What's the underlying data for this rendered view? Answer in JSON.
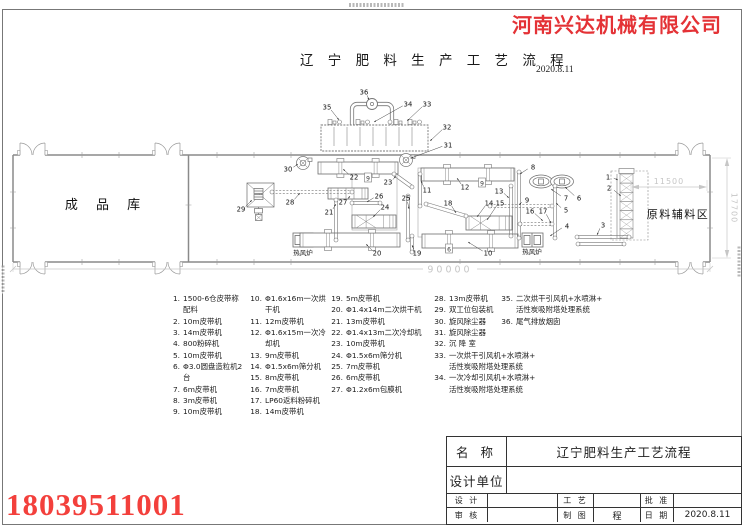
{
  "header": {
    "company": "河南兴达机械有限公司",
    "title": "辽 宁 肥 料 生 产 工 艺 流 程",
    "date": "2020.8.11"
  },
  "footer": {
    "phone": "18039511001"
  },
  "drawing": {
    "area_left": "成 品 库",
    "area_right": "原料辅料区",
    "furnace_label": "热风炉",
    "dimensions": {
      "total_length": "90000",
      "raw_area_width": "11500",
      "building_depth": "17700"
    },
    "tags": [
      {
        "t": "9",
        "x": 368,
        "y": 178
      },
      {
        "t": "9",
        "x": 482,
        "y": 183
      },
      {
        "t": "6",
        "x": 449,
        "y": 249
      }
    ],
    "labels": [
      {
        "n": "1",
        "x": 608,
        "y": 177,
        "tx": 618,
        "ty": 180
      },
      {
        "n": "2",
        "x": 609,
        "y": 188,
        "tx": 621,
        "ty": 196
      },
      {
        "n": "3",
        "x": 603,
        "y": 225,
        "tx": 597,
        "ty": 235
      },
      {
        "n": "4",
        "x": 567,
        "y": 226,
        "tx": 550,
        "ty": 236
      },
      {
        "n": "5",
        "x": 566,
        "y": 210,
        "tx": 556,
        "ty": 203
      },
      {
        "n": "6",
        "x": 579,
        "y": 198,
        "tx": 565,
        "ty": 187
      },
      {
        "n": "7",
        "x": 566,
        "y": 198,
        "tx": 551,
        "ty": 189
      },
      {
        "n": "8",
        "x": 533,
        "y": 167,
        "tx": 520,
        "ty": 174
      },
      {
        "n": "9",
        "x": 527,
        "y": 200,
        "tx": 519,
        "ty": 205
      },
      {
        "n": "10",
        "x": 488,
        "y": 253,
        "tx": 468,
        "ty": 242
      },
      {
        "n": "11",
        "x": 427,
        "y": 190,
        "tx": 421,
        "ty": 181
      },
      {
        "n": "12",
        "x": 465,
        "y": 187,
        "tx": 457,
        "ty": 178
      },
      {
        "n": "13",
        "x": 499,
        "y": 191,
        "tx": 509,
        "ty": 198
      },
      {
        "n": "14",
        "x": 489,
        "y": 203,
        "tx": 477,
        "ty": 217
      },
      {
        "n": "15",
        "x": 500,
        "y": 203,
        "tx": 487,
        "ty": 220
      },
      {
        "n": "16",
        "x": 530,
        "y": 211,
        "tx": 543,
        "ty": 221
      },
      {
        "n": "17",
        "x": 543,
        "y": 211,
        "tx": 551,
        "ty": 223
      },
      {
        "n": "18",
        "x": 448,
        "y": 203,
        "tx": 456,
        "ty": 213
      },
      {
        "n": "19",
        "x": 417,
        "y": 253,
        "tx": 412,
        "ty": 245
      },
      {
        "n": "20",
        "x": 377,
        "y": 253,
        "tx": 366,
        "ty": 244
      },
      {
        "n": "21",
        "x": 329,
        "y": 212,
        "tx": 336,
        "ty": 204
      },
      {
        "n": "22",
        "x": 354,
        "y": 177,
        "tx": 343,
        "ty": 169
      },
      {
        "n": "23",
        "x": 388,
        "y": 182,
        "tx": 396,
        "ty": 176
      },
      {
        "n": "24",
        "x": 385,
        "y": 207,
        "tx": 373,
        "ty": 217
      },
      {
        "n": "25",
        "x": 406,
        "y": 198,
        "tx": 409,
        "ty": 209
      },
      {
        "n": "26",
        "x": 379,
        "y": 196,
        "tx": 367,
        "ty": 202
      },
      {
        "n": "27",
        "x": 343,
        "y": 202,
        "tx": 350,
        "ty": 196
      },
      {
        "n": "28",
        "x": 290,
        "y": 202,
        "tx": 300,
        "ty": 193
      },
      {
        "n": "29",
        "x": 241,
        "y": 209,
        "tx": 252,
        "ty": 200
      },
      {
        "n": "30",
        "x": 288,
        "y": 169,
        "tx": 298,
        "ty": 164
      },
      {
        "n": "31",
        "x": 448,
        "y": 145,
        "tx": 411,
        "ty": 158
      },
      {
        "n": "32",
        "x": 447,
        "y": 127,
        "tx": 430,
        "ty": 141
      },
      {
        "n": "33",
        "x": 427,
        "y": 104,
        "tx": 407,
        "ty": 121
      },
      {
        "n": "34",
        "x": 408,
        "y": 104,
        "tx": 374,
        "ty": 122
      },
      {
        "n": "35",
        "x": 327,
        "y": 107,
        "tx": 339,
        "ty": 120
      },
      {
        "n": "36",
        "x": 364,
        "y": 92,
        "tx": 369,
        "ty": 100
      }
    ]
  },
  "equipment_list": {
    "columns": [
      [
        {
          "no": "1.",
          "lines": [
            "1500-6仓皮带称配料"
          ]
        },
        {
          "no": "2.",
          "lines": [
            "10m皮带机"
          ]
        },
        {
          "no": "3.",
          "lines": [
            "14m皮带机"
          ]
        },
        {
          "no": "4.",
          "lines": [
            "800粉碎机"
          ]
        },
        {
          "no": "5.",
          "lines": [
            "10m皮带机"
          ]
        },
        {
          "no": "6.",
          "lines": [
            "Φ3.0圆盘造粒机2台"
          ]
        },
        {
          "no": "7.",
          "lines": [
            "6m皮带机"
          ]
        },
        {
          "no": "8.",
          "lines": [
            "3m皮带机"
          ]
        },
        {
          "no": "9.",
          "lines": [
            "10m皮带机"
          ]
        }
      ],
      [
        {
          "no": "10.",
          "lines": [
            "Φ1.6x16m一次烘干机"
          ]
        },
        {
          "no": "11.",
          "lines": [
            "12m皮带机"
          ]
        },
        {
          "no": "12.",
          "lines": [
            "Φ1.6x15m一次冷却机"
          ]
        },
        {
          "no": "13.",
          "lines": [
            "9m皮带机"
          ]
        },
        {
          "no": "14.",
          "lines": [
            "Φ1.5x6m筛分机"
          ]
        },
        {
          "no": "15.",
          "lines": [
            "8m皮带机"
          ]
        },
        {
          "no": "16.",
          "lines": [
            "7m皮带机"
          ]
        },
        {
          "no": "17.",
          "lines": [
            "LP60返料粉碎机"
          ]
        },
        {
          "no": "18.",
          "lines": [
            "14m皮带机"
          ]
        }
      ],
      [
        {
          "no": "19.",
          "lines": [
            "5m皮带机"
          ]
        },
        {
          "no": "20.",
          "lines": [
            "Φ1.4x14m二次烘干机"
          ]
        },
        {
          "no": "21.",
          "lines": [
            "13m皮带机"
          ]
        },
        {
          "no": "22.",
          "lines": [
            "Φ1.4x13m二次冷却机"
          ]
        },
        {
          "no": "23.",
          "lines": [
            "10m皮带机"
          ]
        },
        {
          "no": "24.",
          "lines": [
            "Φ1.5x6m筛分机"
          ]
        },
        {
          "no": "25.",
          "lines": [
            "7m皮带机"
          ]
        },
        {
          "no": "26.",
          "lines": [
            "6m皮带机"
          ]
        },
        {
          "no": "27.",
          "lines": [
            "Φ1.2x6m包膜机"
          ]
        }
      ],
      [
        {
          "no": "28.",
          "lines": [
            "13m皮带机"
          ]
        },
        {
          "no": "29.",
          "lines": [
            "双工位包装机"
          ]
        },
        {
          "no": "30.",
          "lines": [
            "旋风除尘器"
          ]
        },
        {
          "no": "31.",
          "lines": [
            "旋风除尘器"
          ]
        },
        {
          "no": "32.",
          "lines": [
            "沉 降 室"
          ]
        },
        {
          "no": "33.",
          "lines": [
            "一次烘干引风机+水喷淋+",
            "活性炭吸附塔处理系统"
          ]
        },
        {
          "no": "34.",
          "lines": [
            "一次冷却引风机+水喷淋+",
            "活性炭吸附塔处理系统"
          ]
        }
      ],
      [
        {
          "no": "35.",
          "lines": [
            "二次烘干引风机+水喷淋+",
            "活性炭吸附塔处理系统"
          ]
        },
        {
          "no": "36.",
          "lines": [
            "尾气排放烟囱"
          ]
        }
      ]
    ]
  },
  "title_block": {
    "name_label": "名  称",
    "name_value": "辽宁肥料生产工艺流程",
    "unit_label": "设计单位",
    "unit_value": "",
    "row3": [
      "设 计",
      "",
      "工 艺",
      "",
      "批 准",
      ""
    ],
    "row4": [
      "审 核",
      "",
      "制 图",
      "程",
      "日 期",
      "2020.8.11"
    ]
  },
  "colors": {
    "brand_red": "#e43236",
    "phone_red": "#f3403c",
    "dim_gray": "#c6c6c6"
  }
}
